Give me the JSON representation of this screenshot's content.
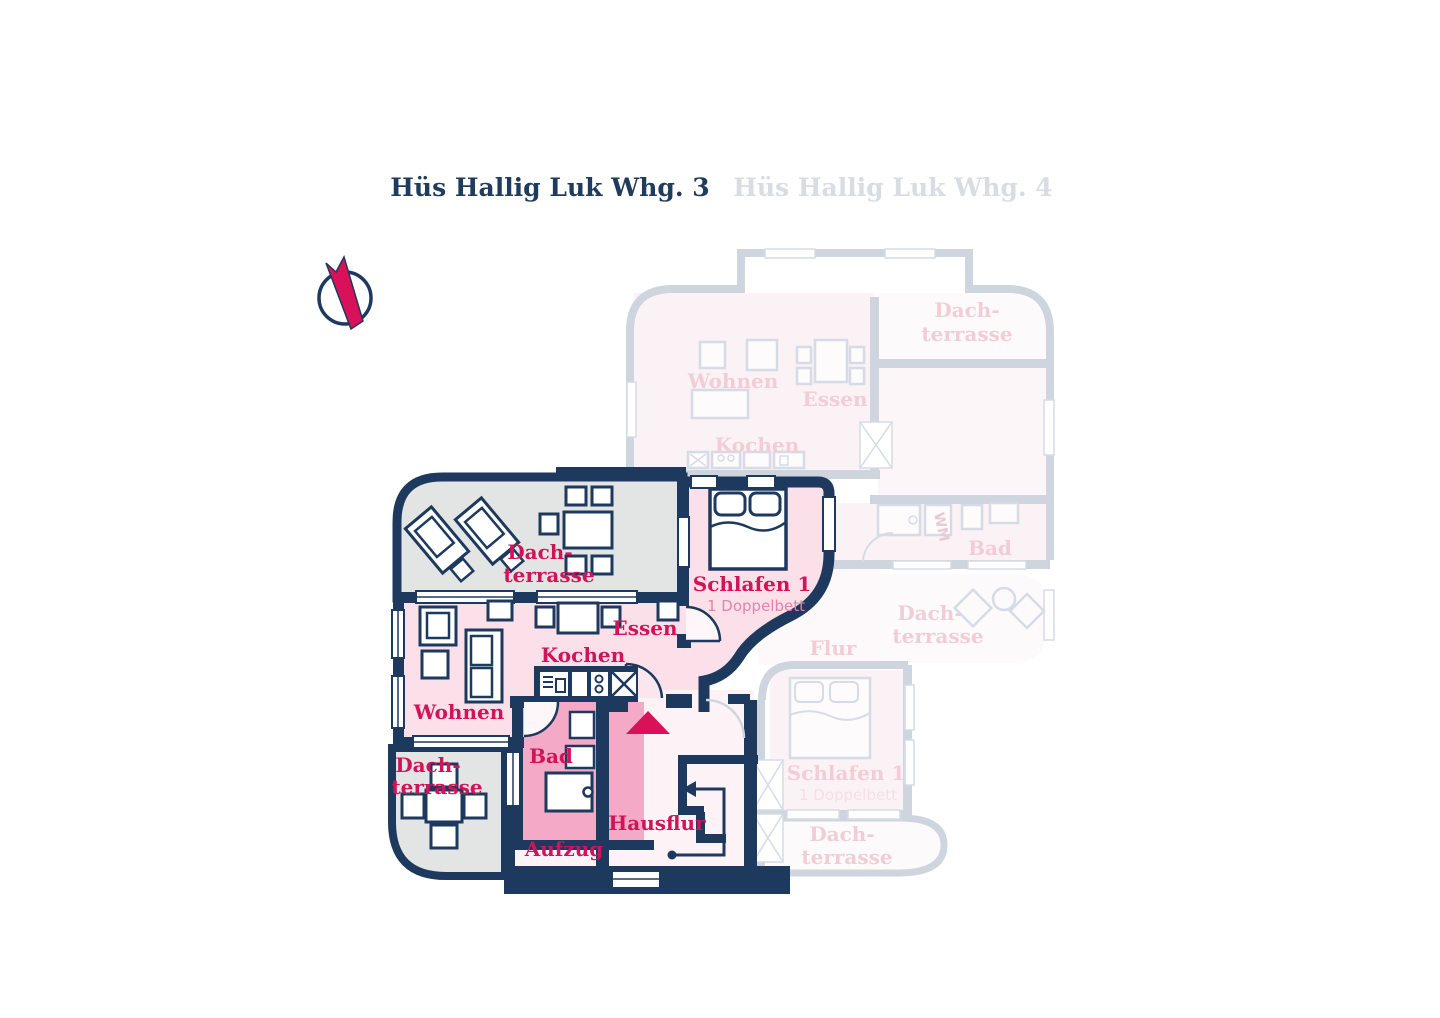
{
  "titles": {
    "active": "Hüs Hallig Luk Whg. 3",
    "inactive": "Hüs Hallig Luk Whg. 4"
  },
  "compass": {
    "icon": "north-arrow"
  },
  "colors": {
    "wall_navy": "#1d3a5e",
    "label_crimson": "#d01459",
    "sublabel_pink": "#e583aa",
    "room_pink": "#fbdfe9",
    "bad_pink": "#f4a9c6",
    "hall_pink": "#fdf2f5",
    "terrace_gray": "#e3e4e4",
    "entrance_marker": "#d81159",
    "faded_wall": "#ced5df",
    "faded_label": "#f2ccd7"
  },
  "main_plan": {
    "labels": {
      "terrace_top_l1": "Dach-",
      "terrace_top_l2": "terrasse",
      "schlafen": "Schlafen 1",
      "schlafen_sub": "1 Doppelbett",
      "essen": "Essen",
      "kochen": "Kochen",
      "wohnen": "Wohnen",
      "bad": "Bad",
      "terrace_bottom_l1": "Dach-",
      "terrace_bottom_l2": "terrasse",
      "aufzug": "Aufzug",
      "hausflur": "Hausflur"
    }
  },
  "faded_plan": {
    "labels": {
      "terrace_top_l1": "Dach-",
      "terrace_top_l2": "terrasse",
      "wohnen": "Wohnen",
      "essen": "Essen",
      "kochen": "Kochen",
      "wm": "WM",
      "bad": "Bad",
      "flur": "Flur",
      "terrace_mid_l1": "Dach-",
      "terrace_mid_l2": "terrasse",
      "schlafen": "Schlafen 1",
      "schlafen_sub": "1 Doppelbett",
      "terrace_bottom_l1": "Dach-",
      "terrace_bottom_l2": "terrasse"
    }
  }
}
